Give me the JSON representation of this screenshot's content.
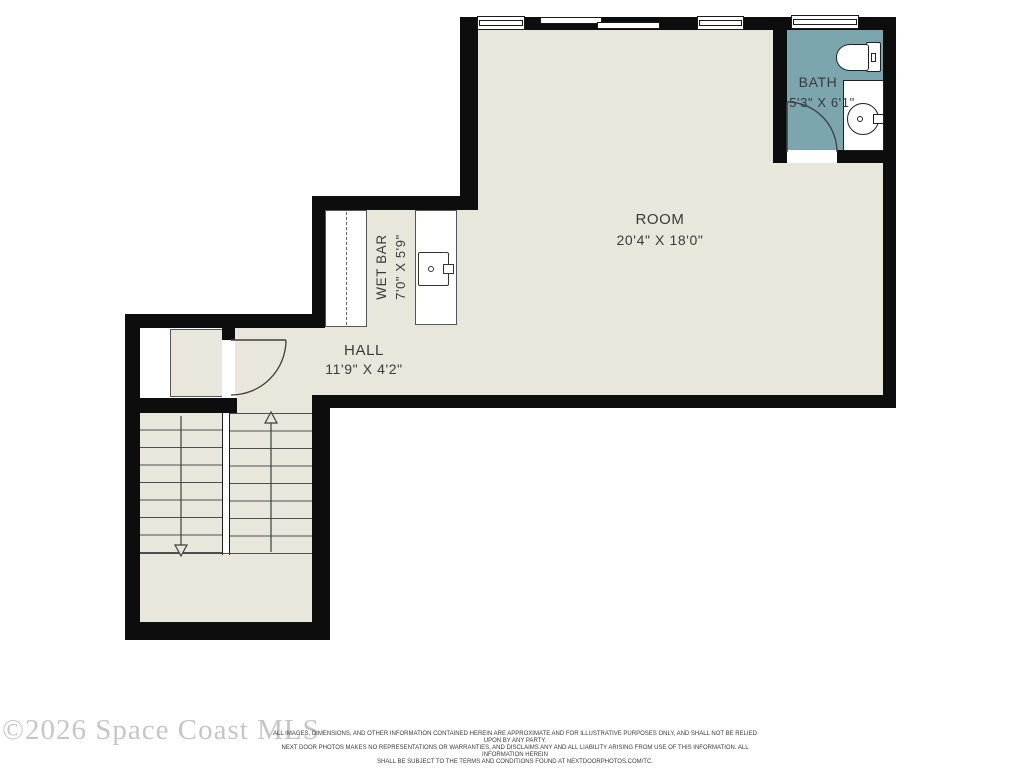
{
  "plan_title": "second floor plan",
  "rooms": {
    "room": {
      "name": "ROOM",
      "dims": "20'4\" X 18'0\""
    },
    "bath": {
      "name": "BATH",
      "dims": "5'3\" X 6'1\""
    },
    "wet_bar": {
      "name": "WET BAR",
      "dims": "7'0\" X 5'9\""
    },
    "hall": {
      "name": "HALL",
      "dims": "11'9\" X 4'2\""
    }
  },
  "stairs": {
    "up_arrow": "up",
    "down_arrow": "down",
    "treads_per_flight": 8
  },
  "footer": {
    "watermark": "©2026 Space Coast MLS",
    "disclaimer_line1": "ALL IMAGES, DIMENSIONS, AND OTHER INFORMATION CONTAINED HEREIN ARE APPROXIMATE AND FOR ILLUSTRATIVE PURPOSES ONLY, AND SHALL NOT BE RELIED UPON BY ANY PARTY.",
    "disclaimer_line2": "NEXT DOOR PHOTOS MAKES NO REPRESENTATIONS OR WARRANTIES, AND DISCLAIMS ANY AND ALL LIABILITY ARISING FROM USE OF THIS INFORMATION. ALL INFORMATION HEREIN",
    "disclaimer_line3": "SHALL BE SUBJECT TO THE TERMS AND CONDITIONS FOUND AT NEXTDOORPHOTOS.COM/TC."
  },
  "colors": {
    "floor": "#e9e7dc",
    "wall": "#0d0d0d",
    "bath": "#7ba6ae",
    "line": "#3f3f3f",
    "watermark": "#c6c6c6"
  }
}
